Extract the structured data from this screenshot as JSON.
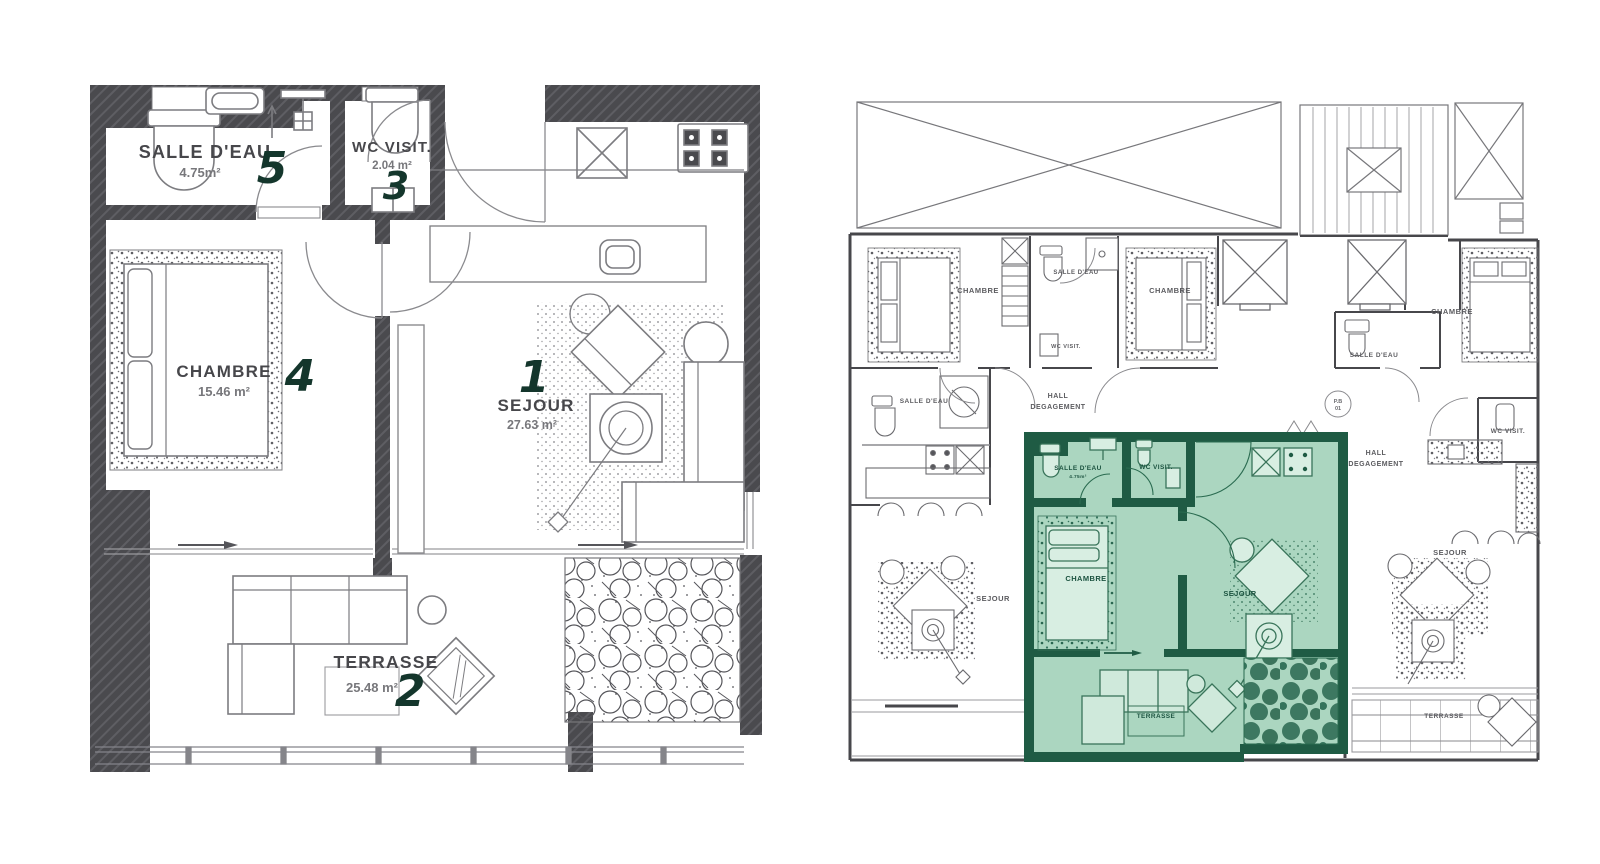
{
  "document": {
    "type": "architectural floor plan sheet",
    "background": "#ffffff"
  },
  "palette": {
    "wall_dark": "#4a4a4e",
    "line_gray": "#7c7c80",
    "line_soft": "#9a9a9e",
    "label_dark": "#47474b",
    "area_gray": "#77777b",
    "number_green": "#14362c",
    "unit_fill": "#abd6c0",
    "unit_fill_light": "#d8eee2",
    "unit_wall": "#1f5b44",
    "unit_line": "#39745a"
  },
  "left_plan": {
    "name": "apartment-detail-plan",
    "rooms": {
      "sejour": {
        "label": "SEJOUR",
        "area": "27.63 m²",
        "number": "1"
      },
      "terrasse": {
        "label": "TERRASSE",
        "area": "25.48 m²",
        "number": "2"
      },
      "wc_visit": {
        "label": "WC VISIT.",
        "area": "2.04 m²",
        "number": "3"
      },
      "chambre": {
        "label": "CHAMBRE",
        "area": "15.46 m²",
        "number": "4"
      },
      "salle_eau": {
        "label": "SALLE D'EAU",
        "area": "4.75m²",
        "number": "5"
      }
    }
  },
  "right_plan": {
    "name": "floor-key-plan",
    "labels": {
      "chambre_top_left": "CHAMBRE",
      "salle_eau_top_middle": "SALLE D'EAU",
      "wc_visit_top_middle": "WC VISIT.",
      "chambre_top_right": "CHAMBRE",
      "chambre_far_right": "CHAMBRE",
      "salle_eau_left": "SALLE D'EAU",
      "hall_left_line1": "HALL",
      "hall_left_line2": "DEGAGEMENT",
      "salle_eau_right": "SALLE D'EAU",
      "wc_visit_right": "WC VISIT.",
      "hall_right_line1": "HALL",
      "hall_right_line2": "DEGAGEMENT",
      "sejour_left": "SEJOUR",
      "sejour_right": "SEJOUR",
      "terrasse_right": "TERRASSE",
      "door_badge_line1": "P.B",
      "door_badge_line2": "01"
    },
    "highlighted_unit": {
      "salle_eau": "SALLE D'EAU",
      "salle_eau_area": "4.75m²",
      "wc_visit": "WC VISIT.",
      "chambre": "CHAMBRE",
      "sejour": "SEJOUR",
      "terrasse": "TERRASSE"
    }
  }
}
